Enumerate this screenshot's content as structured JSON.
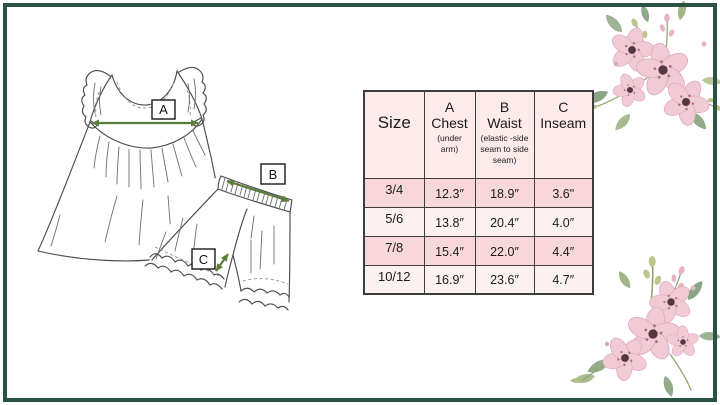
{
  "frame": {
    "border_color": "#2a5345"
  },
  "illustration": {
    "description": "hand-drawn flutter-sleeve top with gathered skirt and ruffle-hem shorts, with measurement arrows",
    "marker_a": "A",
    "marker_b": "B",
    "marker_c": "C",
    "arrow_color": "#5a7d3a",
    "sketch_color": "#4c4c4c"
  },
  "size_table": {
    "header": {
      "size_label": "Size",
      "cols": [
        {
          "letter": "A",
          "name": "Chest",
          "sub": "(under arm)"
        },
        {
          "letter": "B",
          "name": "Waist",
          "sub": "(elastic -side seam to side seam)"
        },
        {
          "letter": "C",
          "name": "Inseam",
          "sub": ""
        }
      ]
    },
    "rows": [
      {
        "size": "3/4",
        "chest": "12.3″",
        "waist": "18.9″",
        "inseam": "3.6\""
      },
      {
        "size": "5/6",
        "chest": "13.8″",
        "waist": "20.4″",
        "inseam": "4.0″"
      },
      {
        "size": "7/8",
        "chest": "15.4″",
        "waist": "22.0″",
        "inseam": "4.4″"
      },
      {
        "size": "10/12",
        "chest": "16.9″",
        "waist": "23.6″",
        "inseam": "4.7″"
      }
    ],
    "colors": {
      "header_bg": "#fdeaea",
      "row_alt_bg": "#f8d7da",
      "row_bg": "#fcf1f1",
      "grid": "#3d3d3d"
    }
  },
  "decor": {
    "floral_petal": "#f0cad4",
    "floral_center": "#533640",
    "leaf_green": "#9aab92",
    "bud_pink": "#e6b4c2"
  }
}
